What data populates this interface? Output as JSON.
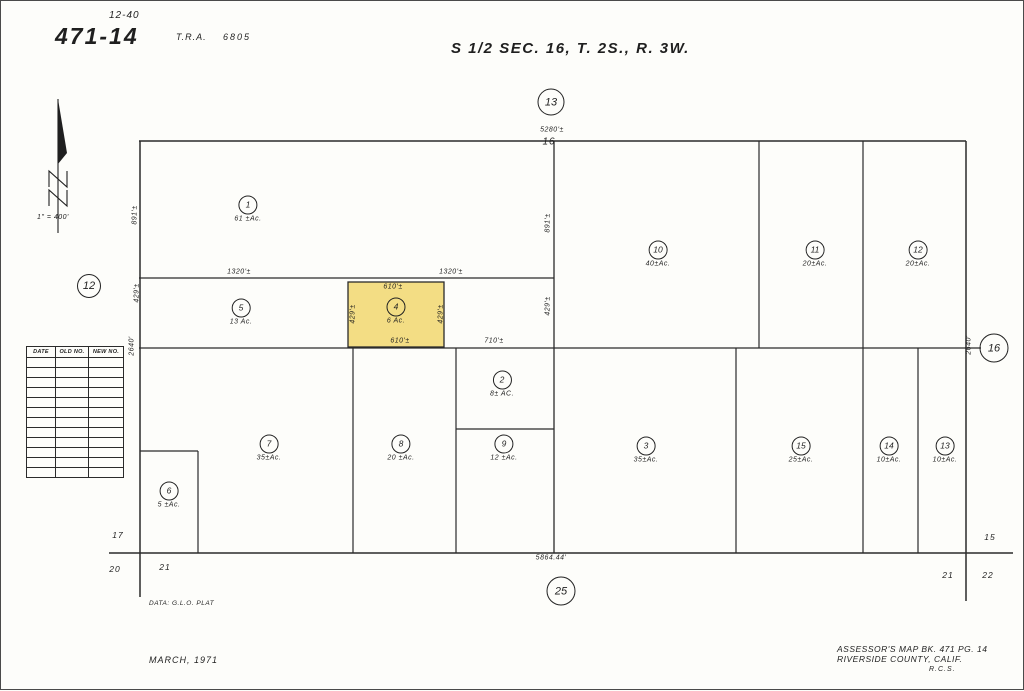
{
  "page": {
    "sheet_ref_top": "12-40",
    "map_number": "471-14",
    "tra_label": "T.R.A.",
    "tra_value": "6805",
    "title": "S 1/2 SEC. 16, T. 2S., R. 3W.",
    "scale": "1\" = 400'",
    "data_source": "DATA: G.L.O. PLAT",
    "date_note": "MARCH, 1971",
    "credit_line1": "ASSESSOR'S MAP BK. 471 PG. 14",
    "credit_line2": "RIVERSIDE COUNTY, CALIF.",
    "credit_initials": "R.C.S."
  },
  "adjacent_pages": [
    {
      "label": "13",
      "x": 550,
      "y": 101,
      "d": 25
    },
    {
      "label": "12",
      "x": 88,
      "y": 285,
      "d": 22
    },
    {
      "label": "16",
      "x": 993,
      "y": 347,
      "d": 27
    },
    {
      "label": "25",
      "x": 560,
      "y": 590,
      "d": 27
    }
  ],
  "parcels": [
    {
      "number": "1",
      "acreage": "61 ±Ac.",
      "x": 247,
      "y": 208,
      "highlighted": false
    },
    {
      "number": "5",
      "acreage": "13 Ac.",
      "x": 240,
      "y": 311,
      "highlighted": false
    },
    {
      "number": "4",
      "acreage": "6 Ac.",
      "x": 395,
      "y": 310,
      "highlighted": true
    },
    {
      "number": "10",
      "acreage": "40±Ac.",
      "x": 657,
      "y": 253,
      "highlighted": false
    },
    {
      "number": "11",
      "acreage": "20±Ac.",
      "x": 814,
      "y": 253,
      "highlighted": false
    },
    {
      "number": "12",
      "acreage": "20±Ac.",
      "x": 917,
      "y": 253,
      "highlighted": false
    },
    {
      "number": "2",
      "acreage": "8± AC.",
      "x": 501,
      "y": 383,
      "highlighted": false
    },
    {
      "number": "7",
      "acreage": "35±Ac.",
      "x": 268,
      "y": 447,
      "highlighted": false
    },
    {
      "number": "8",
      "acreage": "20 ±Ac.",
      "x": 400,
      "y": 447,
      "highlighted": false
    },
    {
      "number": "9",
      "acreage": "12 ±Ac.",
      "x": 503,
      "y": 447,
      "highlighted": false
    },
    {
      "number": "3",
      "acreage": "35±Ac.",
      "x": 645,
      "y": 449,
      "highlighted": false
    },
    {
      "number": "15",
      "acreage": "25±Ac.",
      "x": 800,
      "y": 449,
      "highlighted": false
    },
    {
      "number": "14",
      "acreage": "10±Ac.",
      "x": 888,
      "y": 449,
      "highlighted": false
    },
    {
      "number": "13",
      "acreage": "10±Ac.",
      "x": 944,
      "y": 449,
      "highlighted": false
    },
    {
      "number": "6",
      "acreage": "5 ±Ac.",
      "x": 168,
      "y": 494,
      "highlighted": false
    }
  ],
  "dimensions": [
    {
      "text": "5280'±",
      "x": 551,
      "y": 129,
      "rot": 0
    },
    {
      "text": "1320'±",
      "x": 238,
      "y": 271,
      "rot": 0
    },
    {
      "text": "1320'±",
      "x": 450,
      "y": 271,
      "rot": 0
    },
    {
      "text": "610'±",
      "x": 392,
      "y": 286,
      "rot": 0
    },
    {
      "text": "610'±",
      "x": 399,
      "y": 340,
      "rot": 0
    },
    {
      "text": "710'±",
      "x": 493,
      "y": 340,
      "rot": 0
    },
    {
      "text": "5864.44'",
      "x": 550,
      "y": 557,
      "rot": 0
    },
    {
      "text": "891'±",
      "x": 134,
      "y": 214,
      "rot": -90
    },
    {
      "text": "429'±",
      "x": 136,
      "y": 292,
      "rot": -90
    },
    {
      "text": "2640'",
      "x": 131,
      "y": 345,
      "rot": -90
    },
    {
      "text": "891'±",
      "x": 547,
      "y": 222,
      "rot": -90
    },
    {
      "text": "429'±",
      "x": 547,
      "y": 305,
      "rot": -90
    },
    {
      "text": "429'±",
      "x": 352,
      "y": 313,
      "rot": -90
    },
    {
      "text": "429'±",
      "x": 440,
      "y": 313,
      "rot": -90
    },
    {
      "text": "2640'",
      "x": 968,
      "y": 344,
      "rot": -90
    }
  ],
  "section_labels": [
    {
      "text": "16",
      "x": 548,
      "y": 141
    },
    {
      "text": "17",
      "x": 117,
      "y": 534
    },
    {
      "text": "20",
      "x": 114,
      "y": 568
    },
    {
      "text": "21",
      "x": 164,
      "y": 566
    },
    {
      "text": "15",
      "x": 989,
      "y": 536
    },
    {
      "text": "21",
      "x": 947,
      "y": 574
    },
    {
      "text": "22",
      "x": 987,
      "y": 574
    }
  ],
  "revision_table": {
    "headers": [
      "DATE",
      "OLD NO.",
      "NEW NO."
    ],
    "empty_rows": 12
  },
  "colors": {
    "highlight_fill": "#f3dd84",
    "line": "#2b2b2b",
    "paper": "#fdfdfa"
  }
}
